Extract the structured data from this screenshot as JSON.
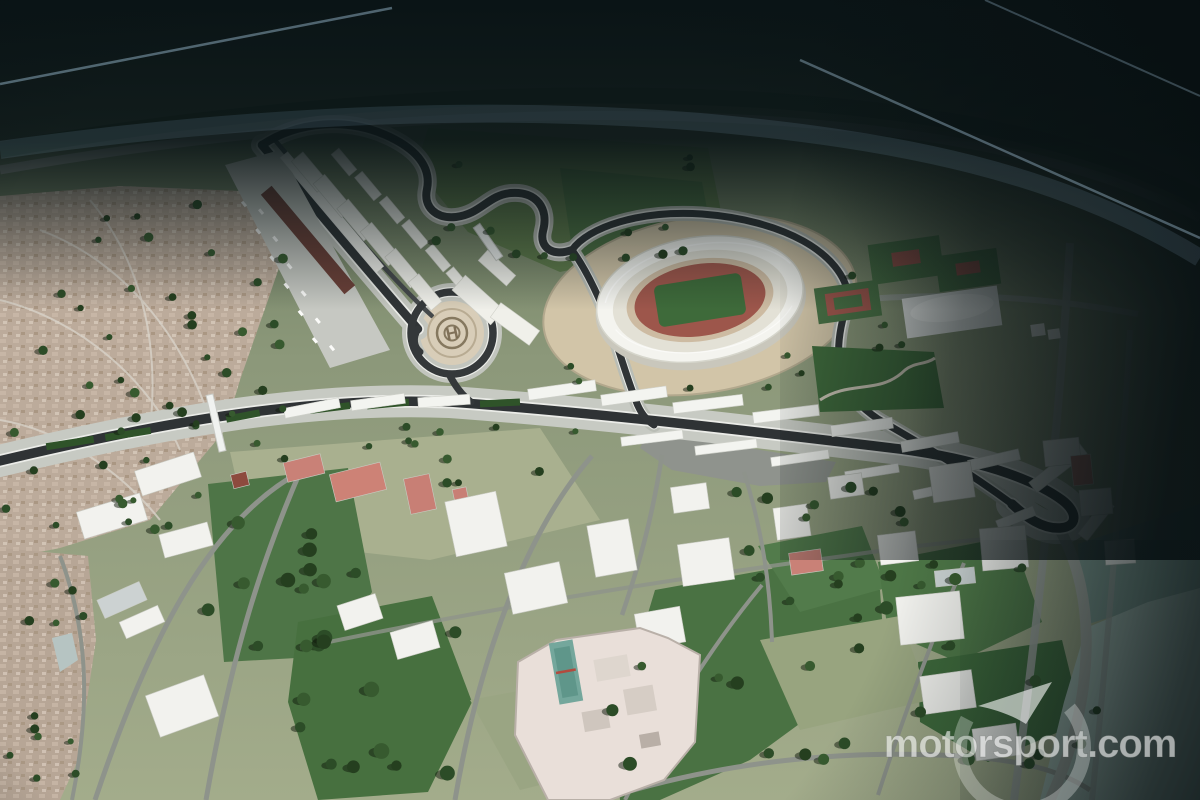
{
  "page": {
    "type": "press-render",
    "subject": "Aerial 3D rendering of a planned grand prix street circuit beside a national stadium, with pit complex, helipad, grandstands and surrounding city blocks"
  },
  "watermark": {
    "text": "motorsport.com",
    "color": "#ffffff",
    "opacity": "0.62",
    "logo": "motorsport-swirl"
  },
  "helipad": {
    "emblem": "H"
  },
  "palette": {
    "vignette": "#0a1416",
    "terrain": "#8c987a",
    "lawn": "#4a7243",
    "city": "#bcab9b",
    "road": "#c7cac3",
    "asphalt": "#2f3335",
    "stadium_roof": "#f4f4ef",
    "athletics_track": "#9d564b",
    "infield": "#3e6a3a",
    "plaza": "#d2c5a8",
    "water": "#a6bcb2",
    "grandstand_roof": "#6b4038",
    "plot_red": "#c98177"
  }
}
